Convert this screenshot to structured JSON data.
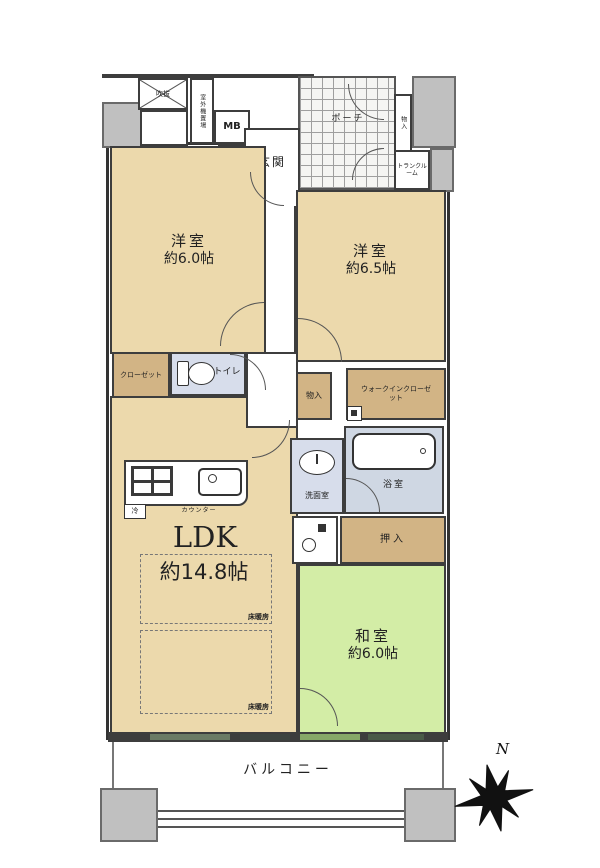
{
  "labels": {
    "fukinuke": "吹抜",
    "outdoor_unit": "室外機置場",
    "mb": "MB",
    "genkan": "玄関",
    "shoe_cabinet": "下足入",
    "porch": "ポーチ",
    "porch_storage": "物入",
    "trunk_room": "トランクルーム",
    "bedroom_left_name": "洋室",
    "bedroom_left_size": "約6.0帖",
    "bedroom_right_name": "洋室",
    "bedroom_right_size": "約6.5帖",
    "closet": "クローゼット",
    "toilet": "トイレ",
    "storage_center": "物入",
    "wic": "ウォークインクローゼット",
    "washroom": "洗面室",
    "bath": "浴室",
    "oshiire": "押入",
    "ldk_name": "LDK",
    "ldk_size": "約14.8帖",
    "counter": "カウンター",
    "fridge": "冷",
    "floor_heating": "床暖房",
    "washitsu_name": "和室",
    "washitsu_size": "約6.0帖",
    "balcony": "バルコニー",
    "compass_north": "N"
  },
  "colors": {
    "room_beige": "#ecd9ac",
    "storage_tan": "#d2b485",
    "washitsu_green": "#d3eda6",
    "water_blue": "#d7ddeb",
    "exterior_gray": "#c0c0c0",
    "wall": "#3d3d3d"
  }
}
